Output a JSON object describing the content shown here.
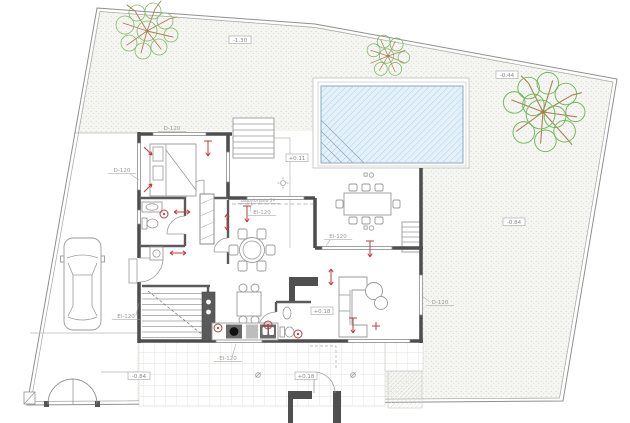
{
  "drawing": {
    "kind": "architectural ground-floor site plan",
    "labels": {
      "elevations": [
        "-1.30",
        "-0.44",
        "-0.84",
        "+0.11",
        "+0.18",
        "+0.18",
        "-0.84"
      ],
      "openings": [
        "D-120",
        "D-120",
        "El-120",
        "El-120",
        "El-120",
        "El-120",
        "D-120"
      ],
      "annotations": [
        "bajo forjado 2º"
      ]
    },
    "colors": {
      "wall": "#4f4f4f",
      "line": "#9a9a9a",
      "red_marker": "#c03b3b",
      "pool_water": "#e4f1fa",
      "pool_hatch": "#b0cfe4",
      "ground_dot": "#d0d0c8",
      "tree_green": "#85bb6a",
      "tree_brown": "#ab7f55"
    }
  }
}
